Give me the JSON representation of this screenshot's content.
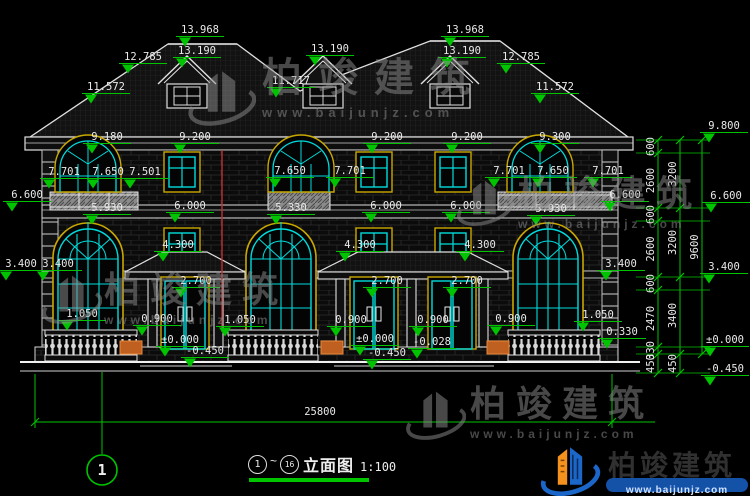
{
  "title_block": {
    "start_bubble": "1",
    "tilde": "~",
    "end_bubble": "16",
    "name": "立面图",
    "scale": "1:100"
  },
  "grid_bubble": {
    "label": "1"
  },
  "overall_dimension": {
    "label": "25800",
    "y": 422,
    "x1": 35,
    "x2": 612,
    "lx": 320,
    "ly": 415
  },
  "brand": {
    "name": "柏竣建筑",
    "url": "www.baijunjz.com"
  },
  "colors": {
    "line": "#e9e9e9",
    "dim": "#00c400",
    "window": "#00dcdc",
    "trim": "#c9a800",
    "red_marker": "#c03030",
    "planter": "#c06020",
    "watermark": "#8f8f8f",
    "logo_blue": "#1b66c9",
    "logo_orange": "#f5921e"
  },
  "elevation_labels": [
    {
      "t": "13.968",
      "x": 200,
      "y": 33
    },
    {
      "t": "13.190",
      "x": 197,
      "y": 54
    },
    {
      "t": "13.190",
      "x": 330,
      "y": 52
    },
    {
      "t": "13.968",
      "x": 465,
      "y": 33
    },
    {
      "t": "13.190",
      "x": 462,
      "y": 54
    },
    {
      "t": "12.785",
      "x": 143,
      "y": 60
    },
    {
      "t": "12.785",
      "x": 521,
      "y": 60
    },
    {
      "t": "11.717",
      "x": 291,
      "y": 84
    },
    {
      "t": "11.572",
      "x": 106,
      "y": 90
    },
    {
      "t": "11.572",
      "x": 555,
      "y": 90
    },
    {
      "t": "9.180",
      "x": 107,
      "y": 140
    },
    {
      "t": "9.200",
      "x": 195,
      "y": 140
    },
    {
      "t": "9.200",
      "x": 387,
      "y": 140
    },
    {
      "t": "9.200",
      "x": 467,
      "y": 140
    },
    {
      "t": "9.300",
      "x": 555,
      "y": 140
    },
    {
      "t": "9.800",
      "x": 724,
      "y": 129
    },
    {
      "t": "7.701",
      "x": 64,
      "y": 175
    },
    {
      "t": "7.650",
      "x": 108,
      "y": 175
    },
    {
      "t": "7.501",
      "x": 145,
      "y": 175
    },
    {
      "t": "7.650",
      "x": 290,
      "y": 174
    },
    {
      "t": "7.701",
      "x": 350,
      "y": 174
    },
    {
      "t": "7.701",
      "x": 509,
      "y": 174
    },
    {
      "t": "7.650",
      "x": 553,
      "y": 174
    },
    {
      "t": "7.701",
      "x": 608,
      "y": 174
    },
    {
      "t": "6.600",
      "x": 27,
      "y": 198
    },
    {
      "t": "6.600",
      "x": 625,
      "y": 198
    },
    {
      "t": "6.600",
      "x": 726,
      "y": 199
    },
    {
      "t": "5.930",
      "x": 107,
      "y": 211
    },
    {
      "t": "6.000",
      "x": 190,
      "y": 209
    },
    {
      "t": "5.330",
      "x": 291,
      "y": 211
    },
    {
      "t": "6.000",
      "x": 386,
      "y": 209
    },
    {
      "t": "6.000",
      "x": 466,
      "y": 209
    },
    {
      "t": "5.930",
      "x": 551,
      "y": 212
    },
    {
      "t": "4.300",
      "x": 178,
      "y": 248
    },
    {
      "t": "4.300",
      "x": 360,
      "y": 248
    },
    {
      "t": "4.300",
      "x": 480,
      "y": 248
    },
    {
      "t": "3.400",
      "x": 21,
      "y": 267
    },
    {
      "t": "3.400",
      "x": 58,
      "y": 267
    },
    {
      "t": "3.400",
      "x": 621,
      "y": 267
    },
    {
      "t": "3.400",
      "x": 724,
      "y": 270
    },
    {
      "t": "2.700",
      "x": 196,
      "y": 284
    },
    {
      "t": "2.700",
      "x": 387,
      "y": 284
    },
    {
      "t": "2.700",
      "x": 467,
      "y": 284
    },
    {
      "t": "1.050",
      "x": 82,
      "y": 317
    },
    {
      "t": "0.900",
      "x": 157,
      "y": 322
    },
    {
      "t": "1.050",
      "x": 240,
      "y": 323
    },
    {
      "t": "0.900",
      "x": 351,
      "y": 323
    },
    {
      "t": "0.900",
      "x": 433,
      "y": 323
    },
    {
      "t": "0.900",
      "x": 511,
      "y": 322
    },
    {
      "t": "1.050",
      "x": 598,
      "y": 318
    },
    {
      "t": "0.330",
      "x": 622,
      "y": 335
    },
    {
      "t": "±0.000",
      "x": 180,
      "y": 343
    },
    {
      "t": "-0.450",
      "x": 205,
      "y": 354
    },
    {
      "t": "±0.000",
      "x": 375,
      "y": 342
    },
    {
      "t": "-0.028",
      "x": 432,
      "y": 345
    },
    {
      "t": "-0.450",
      "x": 387,
      "y": 356
    },
    {
      "t": "±0.000",
      "x": 725,
      "y": 343
    },
    {
      "t": "-0.450",
      "x": 725,
      "y": 372
    }
  ],
  "chains": [
    {
      "x": 658,
      "divs": [
        140,
        153,
        208,
        221,
        277,
        290,
        347,
        354,
        373
      ],
      "labels": [
        "600",
        "2600",
        "600",
        "2600",
        "600",
        "2470",
        "330",
        "450"
      ]
    },
    {
      "x": 680,
      "divs": [
        140,
        208,
        277,
        354,
        373
      ],
      "labels": [
        "3200",
        "3200",
        "3400",
        "450"
      ]
    },
    {
      "x": 702,
      "divs": [
        140,
        354
      ],
      "labels": [
        "9600"
      ]
    }
  ]
}
